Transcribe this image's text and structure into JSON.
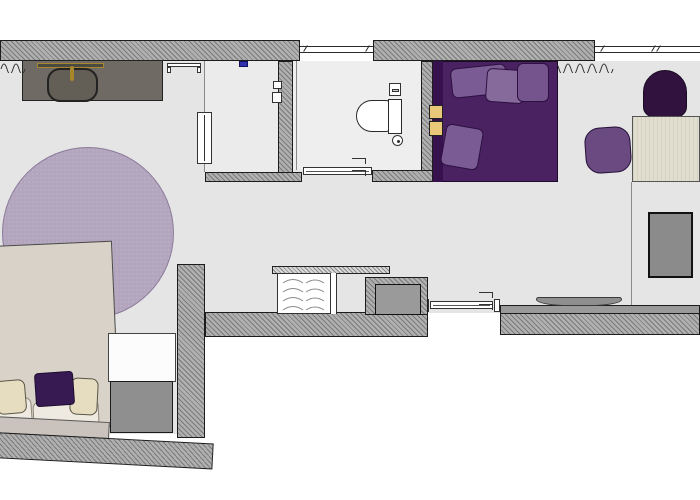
{
  "drawing": {
    "kind": "floor-plan",
    "rooms": [
      "vanity-corridor",
      "wardrobe-closet",
      "bathroom",
      "sleeping-alcove",
      "work-corner",
      "bedroom",
      "entry-hall"
    ],
    "furniture": [
      "vanity-counter",
      "vanity-sink",
      "faucet",
      "wall-shelf",
      "radiator-panel",
      "ceiling-light",
      "light-switches",
      "toilet",
      "toilet-paper-holder",
      "floor-drain",
      "sliding-bathroom-door",
      "daybed",
      "daybed-pillows",
      "yellow-cushions",
      "dark-lounge-chair",
      "desk",
      "desk-chair",
      "tv-panel",
      "console-shelf",
      "minibar-cabinet",
      "counter-top",
      "service-shaft",
      "entry-sliding-door",
      "round-rug",
      "double-bed",
      "bed-pillows",
      "accent-pillow",
      "headboard",
      "nightstand",
      "luggage-bench",
      "curtains",
      "windows"
    ]
  },
  "palette": {
    "floor": "#e5e5e5",
    "floor-b": "#eeeeee",
    "floor-c": "#ebebeb",
    "wall-light": "#b0b0b0",
    "wall-dark": "#7a7a7a",
    "outline": "#1c1c1c",
    "vanity": "#6f6b64",
    "sink": "#635f56",
    "brass": "#a8862c",
    "rug": "#b2a5bd",
    "bed": "#d9d2c8",
    "cream": "#e6ddc1",
    "pillow-under": "#efeae1",
    "headboard": "#cac3bd",
    "purple-deep": "#4a2161",
    "purple-darker": "#37104e",
    "purple-mid": "#7b5b93",
    "purple-mid2": "#866a9c",
    "chair-dark": "#31123f",
    "chair-mid": "#6a4a80",
    "yellow": "#eac87a",
    "desk": "#e2decf",
    "gray-obj": "#8f8f8f",
    "panel-gray": "#8b8b8b",
    "blue": "#2f2fb0",
    "white": "#fcfcfc"
  }
}
